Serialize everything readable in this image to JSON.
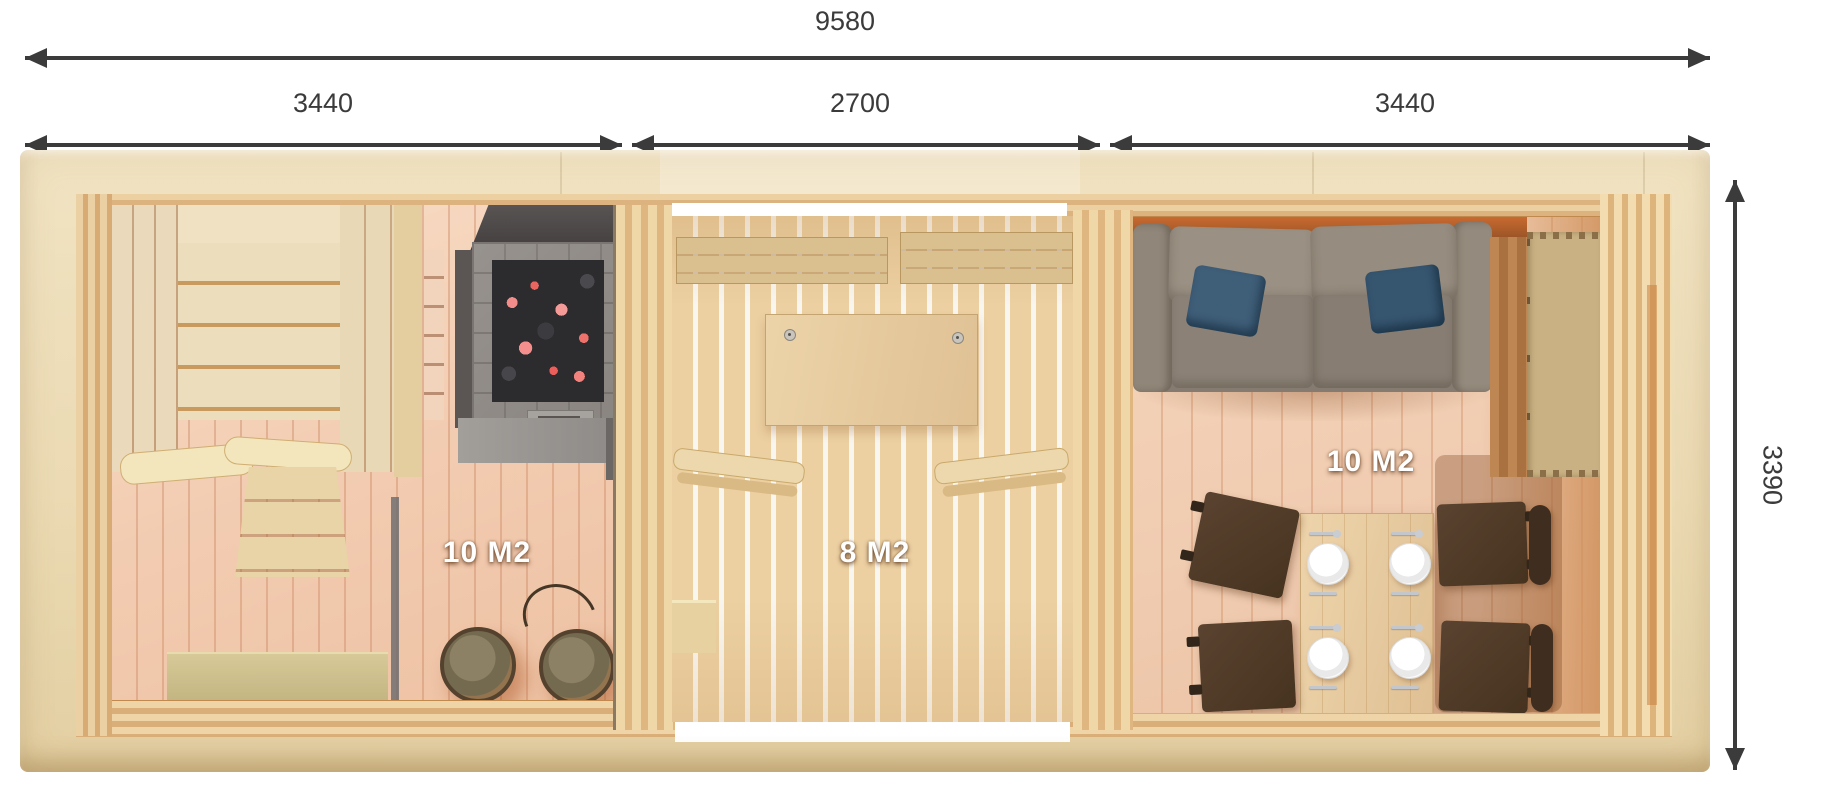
{
  "title": "Sauna cabin floor plan",
  "dimensions": {
    "total_width": "9580",
    "left_section": "3440",
    "middle_section": "2700",
    "right_section": "3440",
    "depth": "3390"
  },
  "rooms": [
    {
      "name": "sauna-room",
      "area": "10 M2"
    },
    {
      "name": "terrace-room",
      "area": "8 M2"
    },
    {
      "name": "lounge-room",
      "area": "10 M2"
    }
  ],
  "colors": {
    "dimension_line": "#3b3b3b",
    "roof_trim": "#ebdab3",
    "pine_wall": "#dcb37f",
    "sauna_floor": "#f2cbb0",
    "terrace_floor": "#ecd0a2",
    "lounge_floor": "#f0cbb0",
    "sofa": "#857b70",
    "pillow": "#3f5e78",
    "chair": "#4e3827",
    "heater_stone": "#908b87",
    "embers": "#f07a76",
    "area_label_text": "#ffffff"
  }
}
